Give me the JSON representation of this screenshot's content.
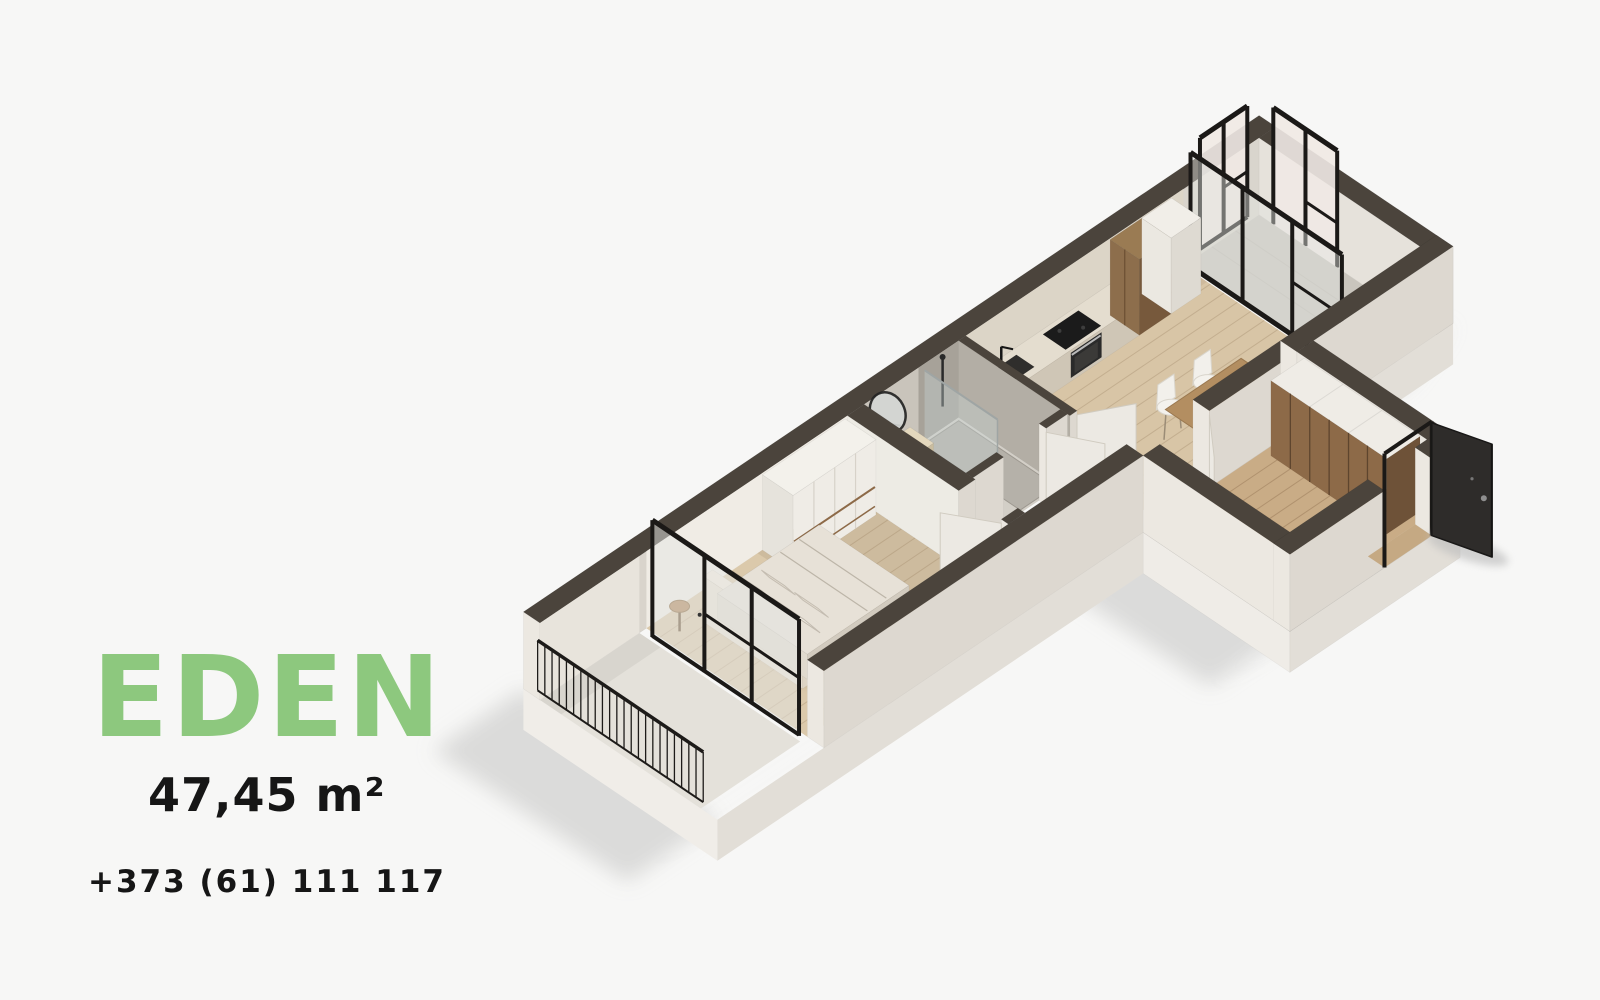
{
  "branding": {
    "title": "EDEN"
  },
  "listing": {
    "area": "47,45 m²",
    "phone": "+373 (61) 111 117"
  },
  "colors": {
    "background": "#f7f7f6",
    "accent_green": "#8dc87e",
    "text_dark": "#161616",
    "wall_top": "#4b443c",
    "wall_light": "#ece8e1",
    "wall_front": "#ddd8d0",
    "frame_black": "#1b1917",
    "wood_floor": "#d8c5a6",
    "wood_entry_floor": "#c9ac86",
    "wood_cabinet": "#8d6a48",
    "counter_front": "#cfc6b6",
    "counter_top": "#e4ddcf",
    "glass": "#e4e6e3",
    "shadow": "#d8d8d7",
    "door_dark": "#2e2c2a",
    "door_white": "#ece9e3"
  }
}
